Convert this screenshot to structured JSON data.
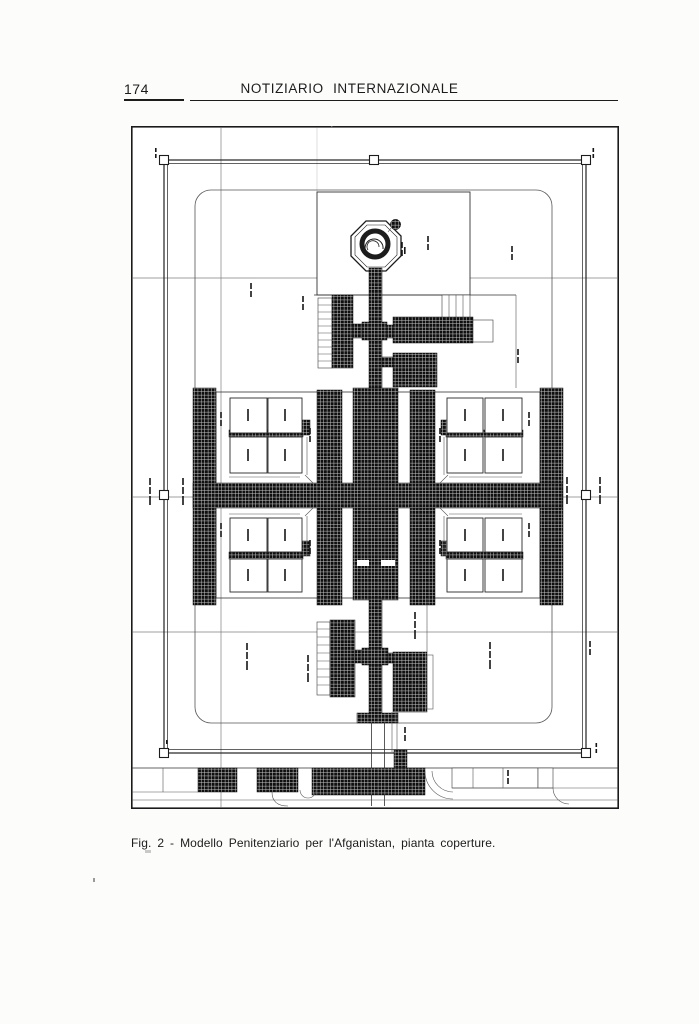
{
  "document": {
    "page_number": "174",
    "header_title": "NOTIZIARIO INTERNAZIONALE",
    "figure": {
      "caption": "Fig. 2 - Modello Penitenziario per l'Afganistan, pianta coperture.",
      "alt": "Architectural roof plan of a model penitentiary: walled rectangular compound with corner watch posts, central octagonal tower, cruciform hatched corridors and four quadrants of cell blocks, entrance strip at bottom"
    },
    "ink_color": "#1c1c1c",
    "paper_color": "#fcfcfb"
  }
}
